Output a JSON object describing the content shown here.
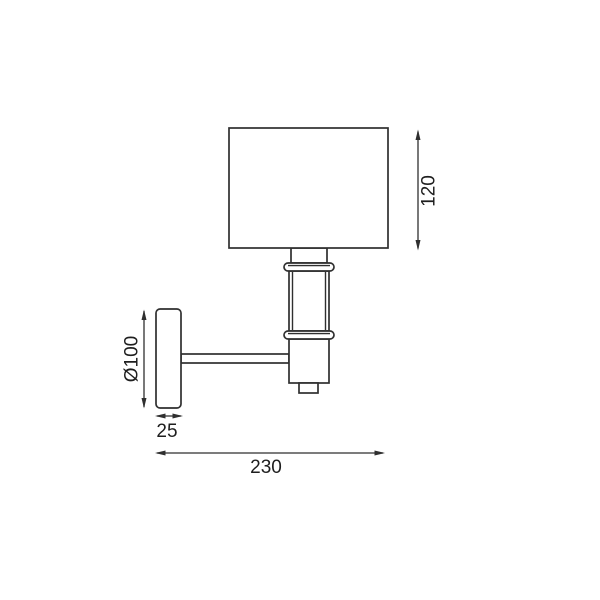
{
  "diagram": {
    "description": "Technical line drawing of a wall-mounted lamp (side view) with dimension annotations",
    "background_color": "#ffffff",
    "line_color": "#2f2f2f",
    "text_color": "#1e1e1e",
    "parts": [
      "lamp-shade",
      "shade-neck",
      "upper-collar",
      "stem-tube",
      "lower-collar",
      "lamp-body",
      "switch-knob",
      "wall-plate",
      "mounting-arm"
    ],
    "dimensions": [
      {
        "id": "shade-height",
        "label": "120",
        "value": 120,
        "orientation": "vertical",
        "measures": "lamp shade height",
        "position": "right-of-shade"
      },
      {
        "id": "backplate-diameter",
        "label": "Ø100",
        "value": 100,
        "orientation": "vertical",
        "measures": "wall plate diameter",
        "position": "left-of-plate"
      },
      {
        "id": "backplate-depth",
        "label": "25",
        "value": 25,
        "orientation": "horizontal",
        "measures": "wall plate depth",
        "position": "below-plate"
      },
      {
        "id": "total-projection",
        "label": "230",
        "value": 230,
        "orientation": "horizontal",
        "measures": "total projection from wall",
        "position": "bottom"
      }
    ]
  }
}
